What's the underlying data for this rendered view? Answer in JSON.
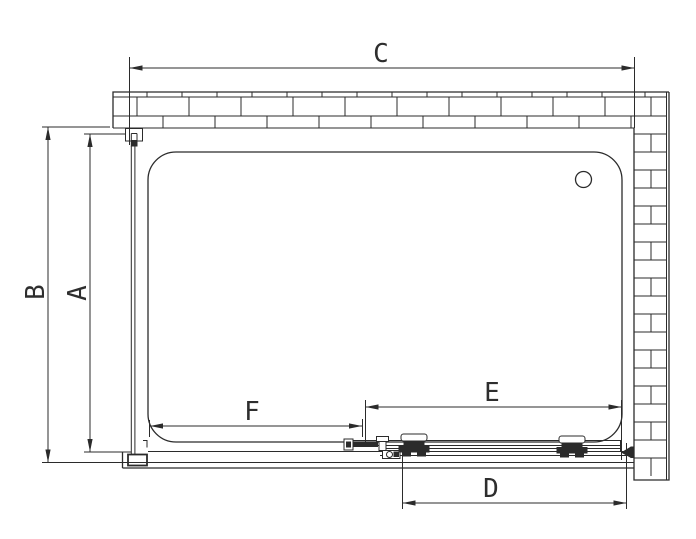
{
  "drawing": {
    "type": "shower-enclosure-plan-view",
    "colors": {
      "line": "#2b2b2b",
      "background": "#ffffff"
    }
  },
  "dimensions": {
    "c": {
      "label": "C"
    },
    "b": {
      "label": "B"
    },
    "a": {
      "label": "A"
    },
    "f": {
      "label": "F"
    },
    "e": {
      "label": "E"
    },
    "d": {
      "label": "D"
    }
  }
}
